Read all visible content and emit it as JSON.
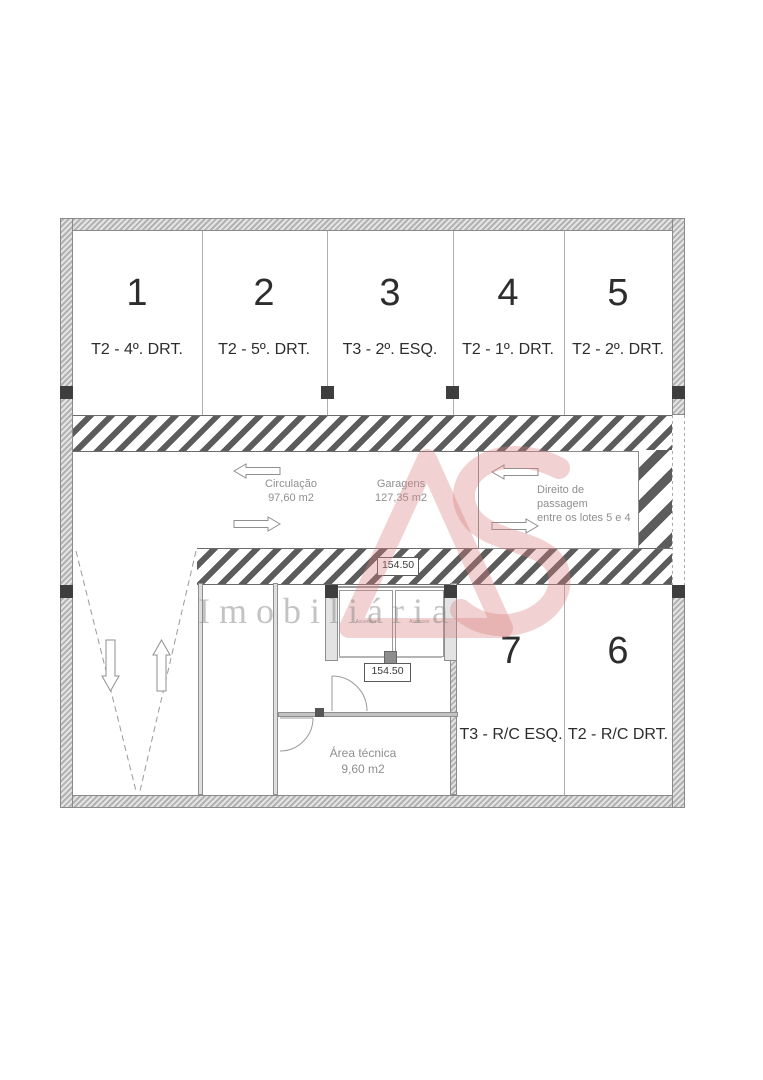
{
  "plan": {
    "spaces_top": [
      {
        "number": "1",
        "label": "T2 - 4º. DRT."
      },
      {
        "number": "2",
        "label": "T2 - 5º. DRT."
      },
      {
        "number": "3",
        "label": "T3 - 2º. ESQ."
      },
      {
        "number": "4",
        "label": "T2 - 1º. DRT."
      },
      {
        "number": "5",
        "label": "T2 - 2º. DRT."
      }
    ],
    "spaces_bottom": [
      {
        "number": "7",
        "label": "T3 - R/C ESQ."
      },
      {
        "number": "6",
        "label": "T2 - R/C DRT."
      }
    ],
    "circulation": {
      "name": "Circulação",
      "area": "97,60 m2"
    },
    "garages": {
      "name": "Garagens",
      "area": "127,35 m2"
    },
    "passage": {
      "line1": "Direito de passagem",
      "line2": "entre os lotes 5 e 4"
    },
    "technical_room": {
      "name": "Área técnica",
      "area": "9,60 m2"
    },
    "levels": {
      "upper": "154.50",
      "lower": "154.50"
    },
    "elevators": {
      "left": "Ascensor",
      "right": "Ascensor"
    }
  },
  "watermark": {
    "text": "Imobiliária",
    "logo_color": "#e5b6b6"
  },
  "colors": {
    "hatch_stripe": "#5c5c5c",
    "wall_fill": "#c9c9c9",
    "pillar": "#3e3e3e",
    "text_dark": "#2d2d2d",
    "text_gray": "#8f8f8f"
  }
}
